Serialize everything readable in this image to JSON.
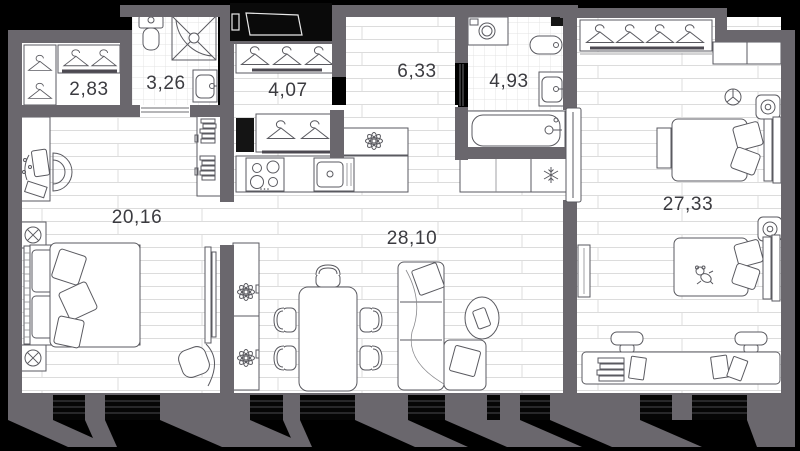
{
  "plan": {
    "type": "apartment-floor-plan",
    "rooms": [
      {
        "name": "wardrobe",
        "area_label": "2,83"
      },
      {
        "name": "shower-room",
        "area_label": "3,26"
      },
      {
        "name": "hallway",
        "area_label": "4,07"
      },
      {
        "name": "corridor",
        "area_label": "6,33"
      },
      {
        "name": "bathroom",
        "area_label": "4,93"
      },
      {
        "name": "bedroom-1",
        "area_label": "20,16"
      },
      {
        "name": "living-kitchen",
        "area_label": "28,10"
      },
      {
        "name": "bedroom-2",
        "area_label": "27,33"
      }
    ],
    "colors": {
      "background": "#000000",
      "wall": "#6a676d",
      "floor": "#ffffff",
      "plank_line": "#dcdcdc",
      "tile_line": "#e3e3e3",
      "furniture_line": "#5a5a60",
      "label_text": "#3b3b40",
      "window": "#060606"
    },
    "icons": [
      "hanger-icon",
      "toilet-icon",
      "shower-icon",
      "sink-icon",
      "bathtub-icon",
      "washing-machine-icon",
      "stove-icon",
      "kitchen-sink-icon",
      "fridge-snowflake-icon",
      "bed-icon",
      "pillow-icon",
      "sofa-icon",
      "dining-table-icon",
      "chair-icon",
      "stool-icon",
      "desk-icon",
      "bookshelf-icon",
      "plant-flower-icon",
      "lamp-icon",
      "outlet-icon",
      "fan-icon",
      "teddy-bear-icon",
      "tv-panel-icon",
      "vent-shaft-icon"
    ]
  }
}
